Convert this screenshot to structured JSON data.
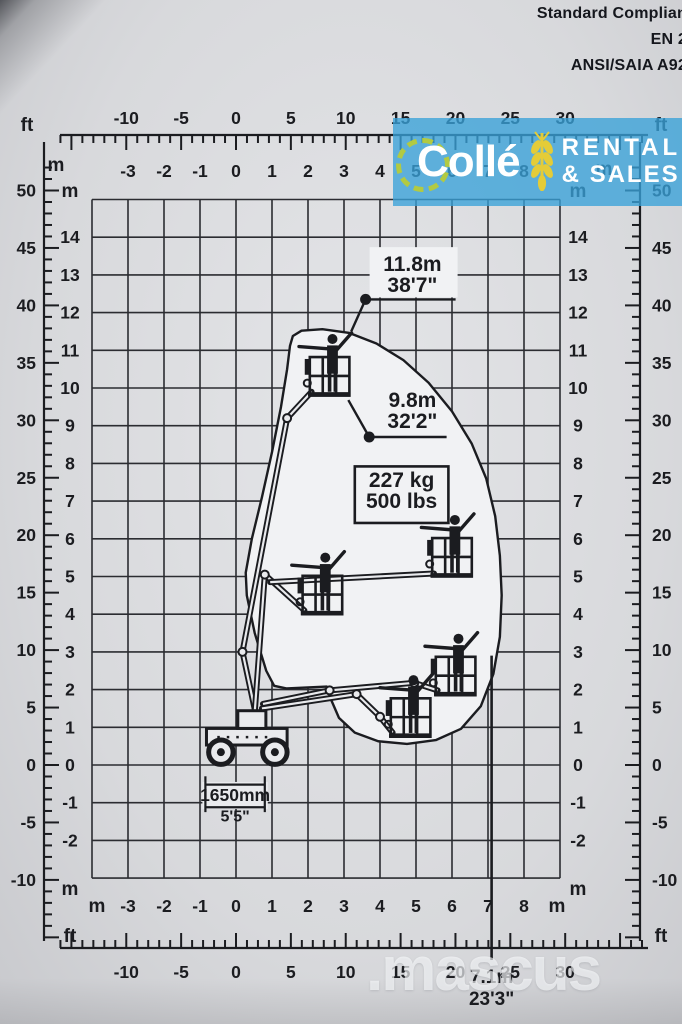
{
  "header": {
    "compliance_lines": [
      "Standard Complian",
      "EN 2",
      "ANSI/SAIA A92"
    ]
  },
  "logo": {
    "brand": "Collé",
    "tagline_line1": "RENTAL",
    "tagline_line2": "& SALES",
    "bg_color": "#39a2d8",
    "gear_color": "#b7cc3a",
    "wheat_color": "#e4cc38"
  },
  "watermark": {
    "text": ".mascus"
  },
  "chart_data": {
    "type": "area",
    "title": "Articulated boom lift working range diagram",
    "grid": {
      "on": true,
      "x_range_m": [
        -4,
        9
      ],
      "y_range_m": [
        -3,
        15
      ]
    },
    "axes": {
      "metric_unit": "m",
      "imperial_unit": "ft",
      "x_ticks_m": [
        -3,
        -2,
        -1,
        0,
        1,
        2,
        3,
        4,
        5,
        6,
        7,
        8
      ],
      "y_ticks_m": [
        14,
        13,
        12,
        11,
        10,
        9,
        8,
        7,
        6,
        5,
        4,
        3,
        2,
        1,
        0,
        -1,
        -2
      ],
      "x_ticks_ft": [
        -10,
        -5,
        0,
        5,
        10,
        15,
        20,
        25,
        30
      ],
      "y_ticks_ft": [
        50,
        45,
        40,
        35,
        30,
        25,
        20,
        15,
        10,
        5,
        0,
        -5,
        -10
      ]
    },
    "envelope_polygon_m": [
      [
        1.5,
        11.12
      ],
      [
        1.58,
        11.38
      ],
      [
        1.82,
        11.52
      ],
      [
        2.4,
        11.56
      ],
      [
        3.15,
        11.46
      ],
      [
        3.9,
        11.18
      ],
      [
        4.65,
        10.74
      ],
      [
        5.35,
        10.14
      ],
      [
        6.0,
        9.38
      ],
      [
        6.55,
        8.52
      ],
      [
        6.95,
        7.6
      ],
      [
        7.2,
        6.6
      ],
      [
        7.33,
        5.55
      ],
      [
        7.38,
        4.5
      ],
      [
        7.33,
        3.4
      ],
      [
        7.15,
        2.42
      ],
      [
        6.8,
        1.56
      ],
      [
        6.25,
        0.96
      ],
      [
        5.55,
        0.66
      ],
      [
        4.75,
        0.56
      ],
      [
        3.95,
        0.63
      ],
      [
        3.3,
        0.86
      ],
      [
        2.86,
        1.25
      ],
      [
        2.62,
        1.78
      ],
      [
        2.52,
        2.08
      ],
      [
        1.4,
        2.03
      ],
      [
        1.06,
        2.1
      ],
      [
        0.84,
        2.5
      ],
      [
        0.52,
        3.5
      ],
      [
        0.3,
        4.5
      ],
      [
        0.27,
        5.1
      ],
      [
        0.44,
        6.0
      ],
      [
        0.72,
        7.1
      ],
      [
        1.0,
        8.3
      ],
      [
        1.25,
        9.5
      ],
      [
        1.42,
        10.5
      ]
    ],
    "machine": {
      "chassis": {
        "body": [
          -0.82,
          0.53,
          2.24,
          0.44
        ],
        "turret": [
          0.05,
          0.97,
          0.78,
          0.47
        ],
        "wheels_x": [
          -0.42,
          1.08
        ],
        "wheel_radius": 0.34
      },
      "booms": [
        [
          [
            0.55,
            1.35
          ],
          [
            0.18,
            3.0
          ],
          [
            1.42,
            9.2
          ],
          [
            2.1,
            9.9
          ]
        ],
        [
          [
            0.52,
            1.4
          ],
          [
            0.8,
            5.05
          ],
          [
            1.9,
            4.1
          ]
        ],
        [
          [
            0.95,
            4.85
          ],
          [
            5.5,
            5.08
          ]
        ],
        [
          [
            0.75,
            1.62
          ],
          [
            2.6,
            1.98
          ],
          [
            4.95,
            2.18
          ],
          [
            5.6,
            1.98
          ]
        ],
        [
          [
            0.72,
            1.5
          ],
          [
            3.35,
            1.88
          ],
          [
            4.0,
            1.28
          ],
          [
            4.35,
            0.86
          ]
        ]
      ],
      "platform_positions_m": [
        [
          2.05,
          9.8
        ],
        [
          1.85,
          4.0
        ],
        [
          5.45,
          5.0
        ],
        [
          5.55,
          1.85
        ],
        [
          4.3,
          0.75
        ]
      ]
    },
    "callouts": {
      "working_height": {
        "label_m": "11.8m",
        "label_ft": "38'7\"",
        "dot": [
          3.6,
          12.35
        ],
        "leader": [
          [
            3.2,
            11.5
          ],
          [
            3.6,
            12.35
          ]
        ],
        "line_end": [
          6.1,
          12.35
        ],
        "text_pos": [
          4.9,
          13.1
        ]
      },
      "platform_height": {
        "label_m": "9.8m",
        "label_ft": "32'2\"",
        "dot": [
          3.7,
          8.7
        ],
        "leader": [
          [
            3.12,
            9.68
          ],
          [
            3.7,
            8.7
          ]
        ],
        "line_end": [
          5.85,
          8.7
        ],
        "text_pos": [
          4.9,
          9.5
        ]
      },
      "capacity": {
        "label_kg": "227 kg",
        "label_lbs": "500 lbs",
        "box": [
          3.3,
          6.42,
          2.6,
          1.5
        ],
        "text_pos": [
          4.6,
          7.38
        ]
      },
      "chassis_width": {
        "label_mm": "1650mm",
        "label_ft": "5'5\"",
        "x1": -0.85,
        "x2": 0.8,
        "y": -0.52
      },
      "outreach": {
        "label_m": "7.1m",
        "label_ft": "23'3\"",
        "x": 7.1,
        "y_top": 2.9
      }
    }
  }
}
